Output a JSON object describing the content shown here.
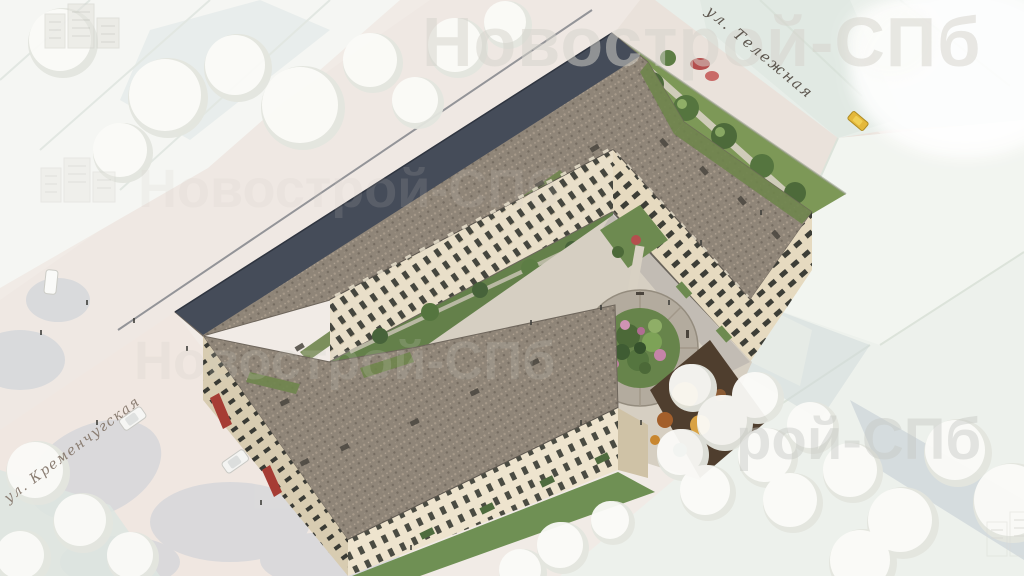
{
  "scene": {
    "description": "Aerial 3D render of a beige classical residential complex with inner courtyard, circular garden, roof terraces and playground; surrounding context buildings and trees are ghosted white",
    "developer_watermark": "Новострой-СПб"
  },
  "watermark": {
    "brand": "Новострой-СПб",
    "partial_bottom_right": "рой-СПб"
  },
  "street_labels": {
    "top_right": "ул. Тележная",
    "bottom_left": "ул. Кременчугская"
  },
  "palette": {
    "facade_beige": "#e9dfc9",
    "facade_shaded": "#d8ccb1",
    "roof_speckle": "#8f8578",
    "roof_slope_dark": "#454c59",
    "roof_terrace_green": "#6f854c",
    "park_green": "#7d9857",
    "lawn_green": "#6f9054",
    "courtyard_paving": "#d6cfc2",
    "street": "#efe8e3",
    "ghost_building_white": "#f3f5f1",
    "awning_red": "#a63c34",
    "taxi_yellow": "#e4b83c",
    "playground_orange": "#c8862f",
    "flower_pink": "#c584a8"
  }
}
